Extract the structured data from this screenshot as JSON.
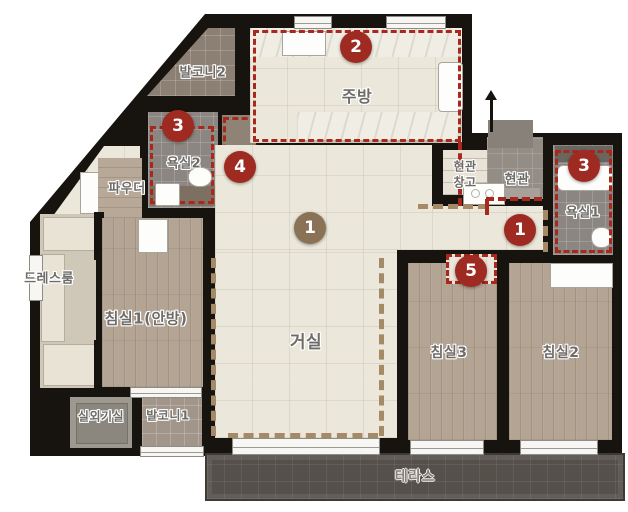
{
  "rooms": {
    "balcony2": {
      "label": "발코니2"
    },
    "kitchen": {
      "label": "주방"
    },
    "bath2": {
      "label": "욕실2"
    },
    "powder": {
      "label": "파우더"
    },
    "entry_storage": {
      "label_line1": "현관",
      "label_line2": "창고"
    },
    "entry": {
      "label": "현관"
    },
    "bath1": {
      "label": "욕실1"
    },
    "dressroom": {
      "label": "드레스룸"
    },
    "bedroom1": {
      "label": "침실1(안방)"
    },
    "living": {
      "label": "거실"
    },
    "bedroom3": {
      "label": "침실3"
    },
    "bedroom2": {
      "label": "침실2"
    },
    "outdoor_unit": {
      "label": "실외기실"
    },
    "balcony1": {
      "label": "발코니1"
    },
    "terrace": {
      "label": "테라스"
    }
  },
  "badges": {
    "living": "1",
    "hallway": "1",
    "kitchen": "2",
    "bath2": "3",
    "bath1": "3",
    "pantry": "4",
    "bedroom3_door": "5"
  },
  "colors": {
    "badge_red": "#9e2a22",
    "badge_brown": "#8a7257",
    "dotted_red": "#a8281e",
    "dashed_tan": "#a58a68",
    "wall_black": "#17140f",
    "living_floor": "#ebe7da",
    "wood_floor": "#b3a494",
    "terrace_floor": "#56504b"
  }
}
